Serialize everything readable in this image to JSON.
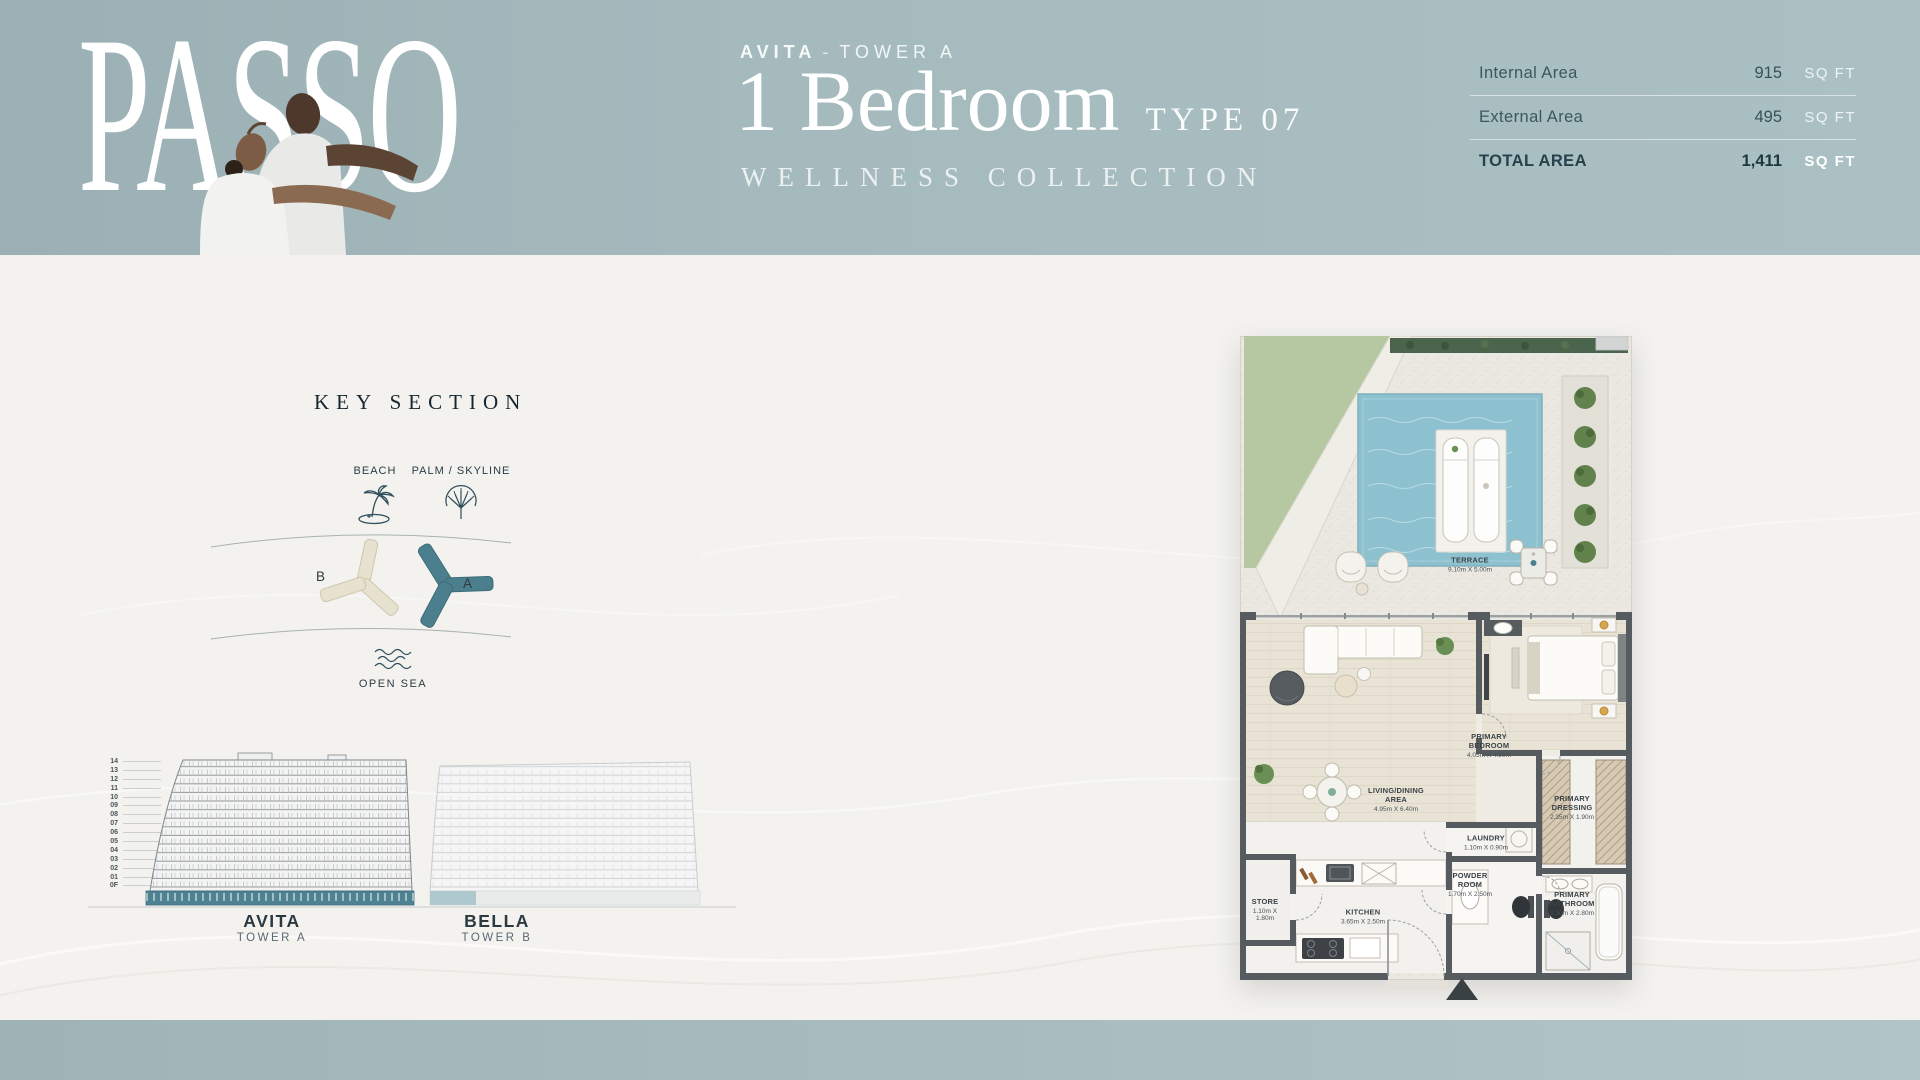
{
  "header": {
    "brand": "PASSO",
    "eyebrow": {
      "project": "AVITA",
      "dash": "-",
      "tower": "TOWER A"
    },
    "unit": {
      "type_title": "1 Bedroom",
      "type_code": "TYPE 07",
      "collection": "WELLNESS COLLECTION"
    },
    "area_table": {
      "rows": [
        {
          "label": "Internal Area",
          "value": "915",
          "unit": "SQ FT"
        },
        {
          "label": "External Area",
          "value": "495",
          "unit": "SQ FT"
        },
        {
          "label": "TOTAL AREA",
          "value": "1,411",
          "unit": "SQ FT"
        }
      ]
    }
  },
  "key_section": {
    "title": "KEY SECTION",
    "landmarks": [
      {
        "label": "BEACH",
        "icon": "palm-island-icon"
      },
      {
        "label": "PALM / SKYLINE",
        "icon": "palm-skyline-icon"
      }
    ],
    "towers": [
      {
        "label": "B",
        "color": "#e6e0cf"
      },
      {
        "label": "A",
        "color": "#4c7f8e"
      }
    ],
    "sea": {
      "label": "OPEN SEA",
      "icon": "waves-icon"
    }
  },
  "elevation": {
    "floors": [
      "14",
      "13",
      "12",
      "11",
      "10",
      "09",
      "08",
      "07",
      "06",
      "05",
      "04",
      "03",
      "02",
      "01",
      "0F"
    ],
    "buildings": [
      {
        "name": "AVITA",
        "tower": "TOWER A"
      },
      {
        "name": "BELLA",
        "tower": "TOWER B"
      }
    ]
  },
  "floor_plan": {
    "entry_icon": "entry-arrow-icon",
    "rooms": [
      {
        "name": "TERRACE",
        "dims": "9.10m X 5.00m"
      },
      {
        "name": "PRIMARY BEDROOM",
        "dims": "4.05m X 4.90m"
      },
      {
        "name": "LIVING/DINING AREA",
        "dims": "4.95m X 6.40m"
      },
      {
        "name": "PRIMARY DRESSING",
        "dims": "2.35m X 1.90m"
      },
      {
        "name": "LAUNDRY",
        "dims": "1.10m X 0.90m"
      },
      {
        "name": "POWDER ROOM",
        "dims": "1.70m X 2.50m"
      },
      {
        "name": "PRIMARY BATHROOM",
        "dims": "2.30m X 2.80m"
      },
      {
        "name": "KITCHEN",
        "dims": "3.65m X 2.50m"
      },
      {
        "name": "STORE",
        "dims": "1.10m X 1.80m"
      }
    ]
  },
  "colors": {
    "band": "#a5babd",
    "accent_teal": "#4c7f8e",
    "accent_cream": "#e6e0cf",
    "text_dark": "#2e454f",
    "pool": "#8dc1cf",
    "lawn": "#b6c8a1"
  }
}
